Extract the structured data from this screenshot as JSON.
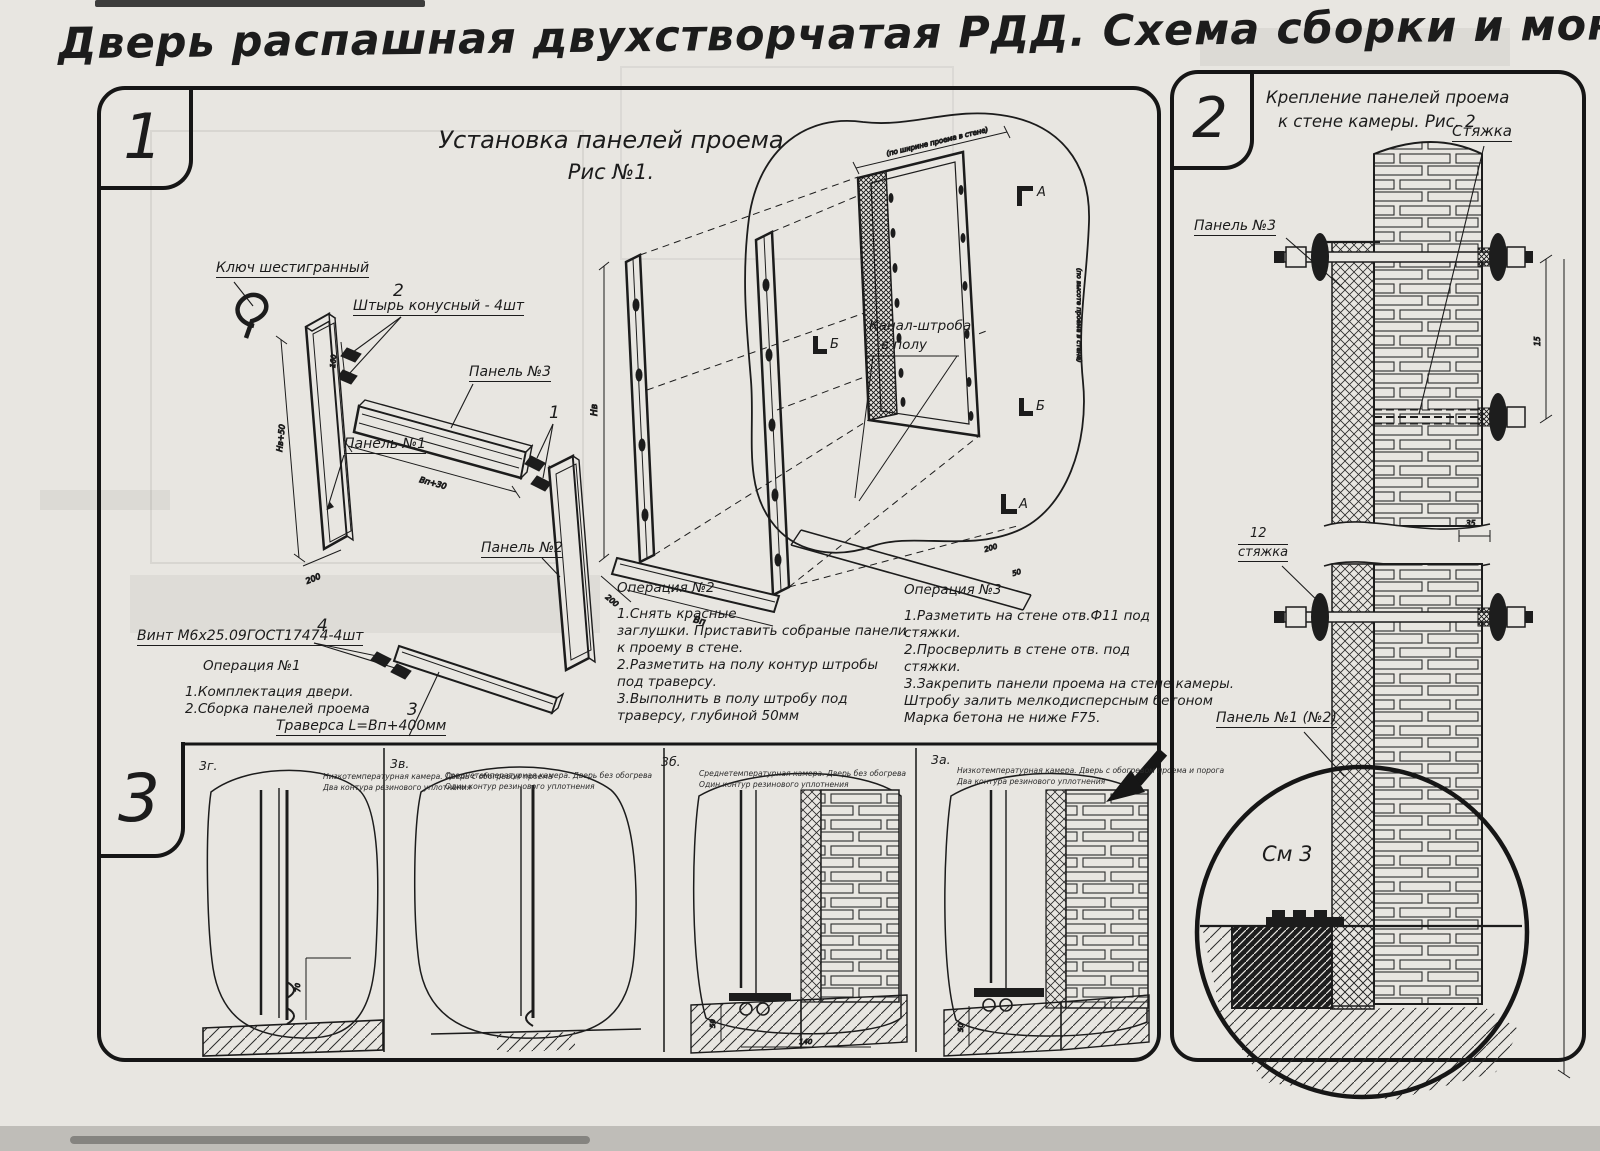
{
  "colors": {
    "paper": "#e8e6e1",
    "ink": "#1c1c1c"
  },
  "title": "Дверь распашная двухстворчатая РДД.  Схема сборки и монтажа №2",
  "fig1": {
    "num": "1",
    "heading1": "Установка панелей проема",
    "heading2": "Рис №1.",
    "labels": {
      "hex_key": "Ключ шестигранный",
      "pin_num": "2",
      "pin": "Штырь конусный - 4шт",
      "panel3": "Панель №3",
      "joint_num": "1",
      "panel1": "Панель №1",
      "panel2": "Панель №2",
      "screw_num": "4",
      "screw": "Винт М6х25.09ГОСТ17474-4шт",
      "traverse_num": "3",
      "traverse": "Траверса  L=Вп+400мм",
      "channel1": "Канал-штроба",
      "channel2": "в полу",
      "marker_a": "А",
      "marker_b": "Б"
    },
    "dims": {
      "d160": "160",
      "dnv50": "Нв+50",
      "d200": "200",
      "dbp30": "Вп+30",
      "dnv": "Нв",
      "d200m": "200",
      "dbp": "Вп",
      "d200c": "200",
      "d50c": "50",
      "width_note": "(по ширине проема в стене)",
      "height_note": "(по высоте проема в стене)"
    },
    "op1": {
      "title": "Операция №1",
      "lines": [
        "1.Комплектация двери.",
        "2.Сборка панелей проема"
      ]
    },
    "op2": {
      "title": "Операция №2",
      "lines": [
        "1.Снять красные",
        "заглушки. Приставить собраные панели",
        "к проему в стене.",
        "2.Разметить на полу контур штробы",
        "под траверсу.",
        "3.Выполнить в полу штробу под",
        "траверсу, глубиной 50мм"
      ]
    },
    "op3": {
      "title": "Операция №3",
      "lines": [
        "1.Разметить на стене отв.Ф11 под",
        "стяжки.",
        "2.Просверлить в стене отв.   под",
        "стяжки.",
        "3.Закрепить панели проема на стене камеры.",
        "Штробу залить мелкодисперсным бетоном",
        "Марка бетона не ниже   F75."
      ]
    }
  },
  "fig2": {
    "num": "2",
    "title1": "Крепление панелей проема",
    "title2": "к стене камеры. Рис. 2",
    "labels": {
      "tie": "Стяжка",
      "panel3": "Панель №3",
      "item_num": "12",
      "item": "стяжка",
      "panel12": "Панель №1 (№2)",
      "detail": "См 3"
    },
    "dims": {
      "d15": "15",
      "d35": "35"
    }
  },
  "fig3": {
    "num": "3",
    "panels": [
      {
        "id": "3г.",
        "cap1": "Низкотемпературная камера. Дверь с обогревом проема",
        "cap2": "Два контура резинового уплотнения",
        "dim": "70"
      },
      {
        "id": "3в.",
        "cap1": "Среднетемпературная камера. Дверь без обогрева",
        "cap2": "Один контур резинового уплотнения"
      },
      {
        "id": "3б.",
        "cap1": "Среднетемпературная камера. Дверь без обогрева",
        "cap2": "Один контур резинового уплотнения",
        "dim": "140",
        "dim2": "50"
      },
      {
        "id": "3а.",
        "cap1": "Низкотемпературная камера. Дверь с обогревом проема и порога",
        "cap2": "Два контура резинового уплотнения",
        "dim": "50"
      }
    ]
  }
}
